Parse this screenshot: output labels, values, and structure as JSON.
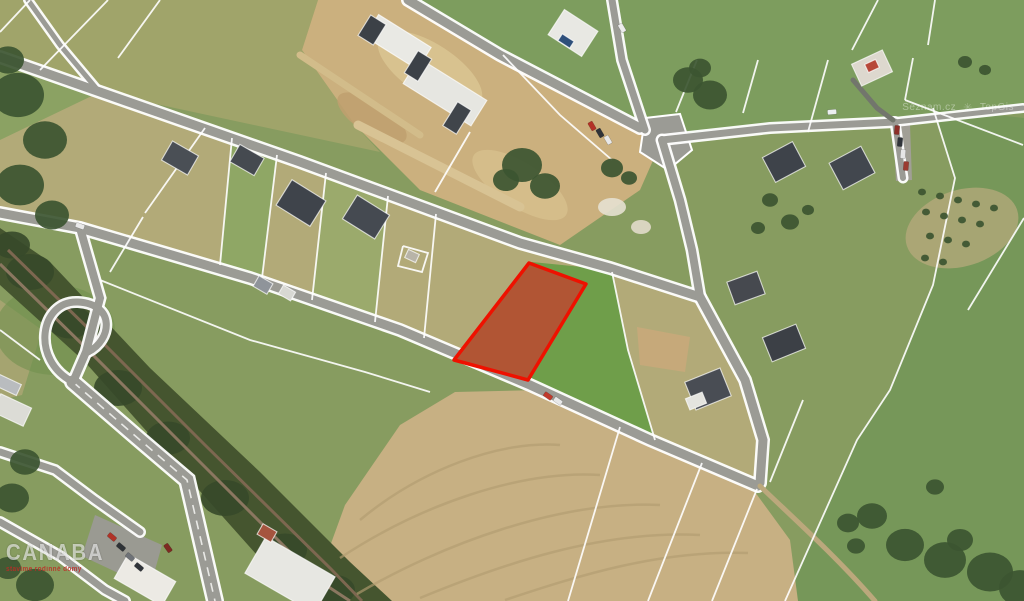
{
  "meta": {
    "kind": "aerial-cadastral-map",
    "width": 1024,
    "height": 601
  },
  "watermarks": {
    "brand": "CANABA",
    "brand_tagline": "stavíme rodinné domy",
    "imagery_credit_1": "Seznam.cz",
    "imagery_credit_separator": "✳",
    "imagery_credit_2": "TopGis"
  },
  "colors": {
    "grass_base": "#879c60",
    "sand": "#cbb07e",
    "road": "#9b9b95",
    "road_casing": "#ffffff",
    "cadastral_line": "#ffffff",
    "rail_corridor": "#45552f",
    "rail_track": "#7d6750",
    "plowed_field": "#c7b083",
    "meadow": "#769759",
    "tree": "#3c5531",
    "parcel_stroke": "#ee1100",
    "parcel_fill": "rgba(226,36,14,0.30)",
    "parcel_ground": "#9c6a45",
    "roof_dark": "#43484f",
    "building_white": "#e8e8e3"
  },
  "map": {
    "fields": [
      {
        "name": "base-grass",
        "shape": "rect",
        "x": 0,
        "y": 0,
        "w": 1024,
        "h": 601,
        "fill": "#879c60"
      },
      {
        "name": "field-top-left",
        "shape": "poly",
        "pts": "0,0 318,0 302,50 355,125 380,152 100,92 0,57",
        "fill": "#a0a46a"
      },
      {
        "name": "field-top-left-corner",
        "shape": "poly",
        "pts": "0,57 100,92 80,120 0,140",
        "fill": "#8ba263"
      },
      {
        "name": "construction-site",
        "shape": "poly",
        "pts": "318,0 408,0 640,128 662,140 640,190 560,245 420,190 355,125 302,50",
        "fill": "#cbb07e"
      },
      {
        "name": "sand-light",
        "shape": "ellipse",
        "cx": 430,
        "cy": 70,
        "rx": 60,
        "ry": 26,
        "rot": 33,
        "fill": "#dbc794",
        "opacity": 0.8
      },
      {
        "name": "sand-light",
        "shape": "ellipse",
        "cx": 520,
        "cy": 185,
        "rx": 55,
        "ry": 22,
        "rot": 33,
        "fill": "#d7c08d",
        "opacity": 0.8
      },
      {
        "name": "sand-dirt",
        "shape": "ellipse",
        "cx": 372,
        "cy": 118,
        "rx": 40,
        "ry": 16,
        "rot": 33,
        "fill": "#bfa06e",
        "opacity": 0.85
      },
      {
        "name": "field-band-middle",
        "shape": "poly",
        "pts": "100,92 300,162 520,243 610,268 700,297 745,380 763,440 758,486 650,440 530,385 400,330 250,278 80,228 0,213 0,140",
        "fill": "#b2aa78"
      },
      {
        "name": "band-green-plot",
        "shape": "poly",
        "pts": "232,138 277,155 262,278 220,265",
        "fill": "#8fa765"
      },
      {
        "name": "band-green-plot",
        "shape": "poly",
        "pts": "326,173 388,196 375,322 312,300",
        "fill": "#97aa6a",
        "opacity": 0.85
      },
      {
        "name": "lawn-right-of-parcel",
        "shape": "poly",
        "pts": "532,262 612,270 628,350 655,440 528,380",
        "fill": "#6f9e4a"
      },
      {
        "name": "field-top-right",
        "shape": "poly",
        "pts": "408,0 1024,0 1024,108 895,122 662,140 640,128",
        "fill": "#7d9d5e"
      },
      {
        "name": "meadow-right",
        "shape": "poly",
        "pts": "933,108 955,178 933,285 890,390 857,440 785,601 1024,601 1024,118",
        "fill": "#769759"
      },
      {
        "name": "garden-beige",
        "shape": "ellipse",
        "cx": 962,
        "cy": 228,
        "rx": 58,
        "ry": 38,
        "rot": -18,
        "fill": "#b7a97c",
        "opacity": 0.75
      },
      {
        "name": "plowed-field",
        "shape": "poly",
        "pts": "310,601 345,505 400,425 455,392 540,390 620,425 700,462 755,492 790,540 798,601",
        "fill": "#c7b083"
      },
      {
        "name": "dirt-building-plot",
        "shape": "poly",
        "pts": "637,327 690,337 685,372 640,365",
        "fill": "#c6a97a"
      },
      {
        "name": "tan-left-edge",
        "shape": "poly",
        "pts": "0,300 42,330 22,395 0,400",
        "fill": "#aca674",
        "opacity": 0.8
      },
      {
        "name": "grass-dark-loop",
        "shape": "ellipse",
        "cx": 55,
        "cy": 330,
        "rx": 60,
        "ry": 45,
        "rot": 0,
        "fill": "#71914f",
        "opacity": 0.6
      },
      {
        "name": "parking-lot",
        "shape": "poly",
        "pts": "95,515 162,545 150,588 82,556",
        "fill": "#9a9a92"
      },
      {
        "name": "junction-plaza",
        "shape": "poly",
        "pts": "645,118 680,114 692,150 668,170 640,152",
        "fill": "#9b9b95",
        "stroke": "#ffffff",
        "sw": 2
      },
      {
        "name": "sand-pile",
        "shape": "ellipse",
        "cx": 612,
        "cy": 207,
        "rx": 14,
        "ry": 9,
        "rot": 0,
        "fill": "#e6e1d2",
        "opacity": 0.9
      },
      {
        "name": "sand-pile",
        "shape": "ellipse",
        "cx": 641,
        "cy": 227,
        "rx": 10,
        "ry": 7,
        "rot": 0,
        "fill": "#e2dccb",
        "opacity": 0.9
      },
      {
        "name": "roadside-parking-strip",
        "shape": "poly",
        "pts": "893,125 910,124 912,180 896,181",
        "fill": "#a19f96"
      }
    ],
    "rail": {
      "corridor": "0,228 50,262 150,368 260,472 350,562 392,601 298,601 190,480 85,362 0,285",
      "fill": "#45552f",
      "blob_fill": "#36492a",
      "blobs": [
        [
          30,
          272,
          24
        ],
        [
          70,
          322,
          22
        ],
        [
          118,
          388,
          24
        ],
        [
          168,
          438,
          22
        ],
        [
          225,
          498,
          24
        ],
        [
          285,
          550,
          22
        ],
        [
          335,
          590,
          20
        ],
        [
          12,
          245,
          18
        ]
      ],
      "tracks": [
        {
          "d": "M8,250 L95,335 L205,445 L330,568 L362,601",
          "c": "#7d6750"
        },
        {
          "d": "M0,264 L85,347 L195,457 L318,580 L350,601",
          "c": "#8b7760"
        }
      ],
      "track_w": 3
    },
    "contours": {
      "stroke": "#b29c70",
      "paths": [
        "M360,520 C420,470 500,440 560,445",
        "M340,558 C420,505 520,470 600,475",
        "M357,594 C440,545 560,500 660,505",
        "M420,598 C500,565 600,530 700,535",
        "M505,600 C580,575 660,550 748,553"
      ]
    },
    "roads": [
      {
        "name": "lane-top-left",
        "d": "M28,0 L60,45 L96,88",
        "w": 5
      },
      {
        "name": "road-upper-diagonal",
        "d": "M0,57 L100,92 L300,162 L520,243 L610,268 L700,297",
        "w": 9
      },
      {
        "name": "road-lower-diagonal",
        "d": "M0,213 L80,228 L250,278 L400,330 L530,385 L650,440 L758,486",
        "w": 9
      },
      {
        "name": "road-branch",
        "d": "M80,228 L100,298 L86,352 L73,382",
        "w": 8
      },
      {
        "name": "road-main-bottom-left",
        "d": "M73,382 L140,440 L187,480 L215,601",
        "w": 13,
        "center": true
      },
      {
        "name": "road-construction",
        "d": "M408,0 L500,55 L640,128",
        "w": 9
      },
      {
        "name": "road-north",
        "d": "M612,0 L622,60 L645,130",
        "w": 7
      },
      {
        "name": "road-connector",
        "d": "M662,140 L680,200 L692,250 L700,297",
        "w": 8
      },
      {
        "name": "road-east",
        "d": "M662,140 L770,128 L895,122",
        "w": 7
      },
      {
        "name": "lane-east",
        "d": "M895,122 L1023,108",
        "w": 5
      },
      {
        "name": "road-stub",
        "d": "M895,122 L903,178",
        "w": 6
      },
      {
        "name": "road-southeast",
        "d": "M700,297 L745,380 L763,440 L760,483",
        "w": 9
      },
      {
        "name": "street-1",
        "d": "M0,452 L55,470 L95,500 L140,532",
        "w": 7
      },
      {
        "name": "street-2",
        "d": "M0,522 L60,556 L105,590 L125,601",
        "w": 7
      },
      {
        "name": "loop-ramp",
        "d": "M73,382 C30,360 40,300 78,302 C116,304 112,340 88,352",
        "w": 7
      },
      {
        "name": "driveway",
        "d": "M853,80 L877,108 L893,120",
        "w": 5,
        "color": "#72766c",
        "casing": false
      },
      {
        "name": "dirt-track",
        "d": "M760,486 C790,515 835,555 875,601",
        "w": 5,
        "color": "#bba87c",
        "casing": false
      },
      {
        "name": "dirt-lane",
        "d": "M358,125 L520,207",
        "w": 9,
        "color": "#d8c394",
        "casing": false
      },
      {
        "name": "dirt-lane",
        "d": "M300,55 L420,135",
        "w": 7,
        "color": "#d2bc8a",
        "casing": false
      }
    ],
    "road_color": "#9b9b95",
    "cadastral_lines": [
      "30,0 0,32",
      "108,0 40,70",
      "160,0 118,58",
      "205,128 145,213",
      "232,138 220,265",
      "277,155 262,278",
      "326,173 312,300",
      "388,196 375,322",
      "436,214 424,338",
      "470,132 435,192",
      "503,55 560,115 612,160",
      "612,272 628,350 655,440",
      "697,60 676,112",
      "758,60 743,113",
      "828,60 808,132",
      "913,58 905,100",
      "905,100 1023,145",
      "933,108 955,178 933,285 890,390 857,440 785,601",
      "1024,218 968,310",
      "803,400 770,482",
      "878,0 852,50",
      "935,0 928,45",
      "143,217 110,272",
      "100,280 250,340 365,372 430,392",
      "0,330 40,360",
      "620,427 568,601",
      "702,463 648,601",
      "757,489 712,601",
      "403,246 428,253 422,272 398,266 403,246"
    ],
    "trees": [
      [
        18,
        95,
        26
      ],
      [
        45,
        140,
        22
      ],
      [
        20,
        185,
        24
      ],
      [
        52,
        215,
        17
      ],
      [
        8,
        60,
        16
      ],
      [
        522,
        165,
        20
      ],
      [
        545,
        186,
        15
      ],
      [
        506,
        180,
        13
      ],
      [
        688,
        80,
        15
      ],
      [
        710,
        95,
        17
      ],
      [
        700,
        68,
        11
      ],
      [
        612,
        168,
        11
      ],
      [
        629,
        178,
        8
      ],
      [
        25,
        462,
        15
      ],
      [
        12,
        498,
        17
      ],
      [
        35,
        585,
        19
      ],
      [
        8,
        568,
        13
      ],
      [
        872,
        516,
        15
      ],
      [
        848,
        523,
        11
      ],
      [
        905,
        545,
        19
      ],
      [
        945,
        560,
        21
      ],
      [
        990,
        572,
        23
      ],
      [
        1020,
        588,
        21
      ],
      [
        960,
        540,
        13
      ],
      [
        935,
        487,
        9
      ],
      [
        856,
        546,
        9
      ],
      [
        770,
        200,
        8
      ],
      [
        790,
        222,
        9
      ],
      [
        758,
        228,
        7
      ],
      [
        808,
        210,
        6
      ],
      [
        965,
        62,
        7
      ],
      [
        985,
        70,
        6
      ],
      [
        922,
        192,
        4
      ],
      [
        940,
        196,
        4
      ],
      [
        958,
        200,
        4
      ],
      [
        976,
        204,
        4
      ],
      [
        994,
        208,
        4
      ],
      [
        926,
        212,
        4
      ],
      [
        944,
        216,
        4
      ],
      [
        962,
        220,
        4
      ],
      [
        980,
        224,
        4
      ],
      [
        930,
        236,
        4
      ],
      [
        948,
        240,
        4
      ],
      [
        966,
        244,
        4
      ],
      [
        925,
        258,
        4
      ],
      [
        943,
        262,
        4
      ]
    ],
    "buildings": [
      [
        398,
        42,
        62,
        26,
        32,
        "#e9e9e4"
      ],
      [
        445,
        92,
        80,
        30,
        32,
        "#e6e6e1"
      ],
      [
        372,
        30,
        18,
        24,
        32,
        "#3c4147"
      ],
      [
        418,
        66,
        16,
        26,
        32,
        "#3c4147"
      ],
      [
        457,
        118,
        16,
        28,
        32,
        "#40454b"
      ],
      [
        573,
        33,
        40,
        30,
        33,
        "#e8e8e3"
      ],
      [
        566,
        41,
        14,
        8,
        33,
        "#2e4f7a"
      ],
      [
        180,
        158,
        30,
        22,
        30,
        "#4a4f55"
      ],
      [
        247,
        160,
        28,
        20,
        30,
        "#454a50"
      ],
      [
        301,
        203,
        40,
        30,
        32,
        "#3f444b"
      ],
      [
        366,
        217,
        38,
        28,
        32,
        "#454a51"
      ],
      [
        263,
        285,
        16,
        12,
        30,
        "#8f949a"
      ],
      [
        287,
        293,
        14,
        10,
        30,
        "#d8d8d3"
      ],
      [
        412,
        256,
        12,
        9,
        25,
        "#b8b4a8"
      ],
      [
        872,
        68,
        34,
        24,
        -25,
        "#ddd8ce"
      ],
      [
        872,
        66,
        12,
        9,
        -25,
        "#b7483a"
      ],
      [
        784,
        162,
        34,
        28,
        -28,
        "#3e434a"
      ],
      [
        852,
        168,
        36,
        30,
        -28,
        "#42474e"
      ],
      [
        746,
        288,
        32,
        24,
        -20,
        "#46494f"
      ],
      [
        784,
        343,
        36,
        26,
        -22,
        "#3c4046"
      ],
      [
        708,
        389,
        38,
        30,
        -22,
        "#494d54"
      ],
      [
        696,
        401,
        18,
        12,
        -22,
        "#e4e4df"
      ],
      [
        290,
        575,
        80,
        42,
        30,
        "#e7e7e2"
      ],
      [
        145,
        580,
        55,
        28,
        30,
        "#eceae4"
      ],
      [
        12,
        410,
        34,
        20,
        25,
        "#dcdcd6"
      ],
      [
        8,
        385,
        24,
        12,
        25,
        "#b9bcbf"
      ],
      [
        267,
        533,
        16,
        12,
        30,
        "#a5543e"
      ]
    ],
    "cars": [
      [
        592,
        126,
        60,
        "#b33227"
      ],
      [
        600,
        133,
        60,
        "#2f3338"
      ],
      [
        608,
        140,
        60,
        "#e8e8e8"
      ],
      [
        897,
        130,
        95,
        "#8c2f28"
      ],
      [
        900,
        142,
        95,
        "#30343a"
      ],
      [
        903,
        154,
        95,
        "#e6e6e6"
      ],
      [
        906,
        166,
        95,
        "#9b3b30"
      ],
      [
        548,
        396,
        35,
        "#c0392b"
      ],
      [
        558,
        401,
        35,
        "#e8e8e8"
      ],
      [
        112,
        537,
        40,
        "#b03227"
      ],
      [
        121,
        547,
        40,
        "#2e3236"
      ],
      [
        130,
        557,
        40,
        "#6e7277"
      ],
      [
        139,
        567,
        40,
        "#30343a"
      ],
      [
        168,
        548,
        55,
        "#7e2a22"
      ],
      [
        80,
        226,
        20,
        "#e9e9e9"
      ],
      [
        622,
        28,
        60,
        "#ececec"
      ],
      [
        832,
        112,
        -5,
        "#eceff0"
      ]
    ],
    "highlight_parcel": {
      "pts": "529,263 586,284 528,380 454,360",
      "ground": "#9c6a45",
      "fill": "rgba(226,36,14,0.30)",
      "stroke": "#ee1100",
      "stroke_width": 3.5
    }
  }
}
